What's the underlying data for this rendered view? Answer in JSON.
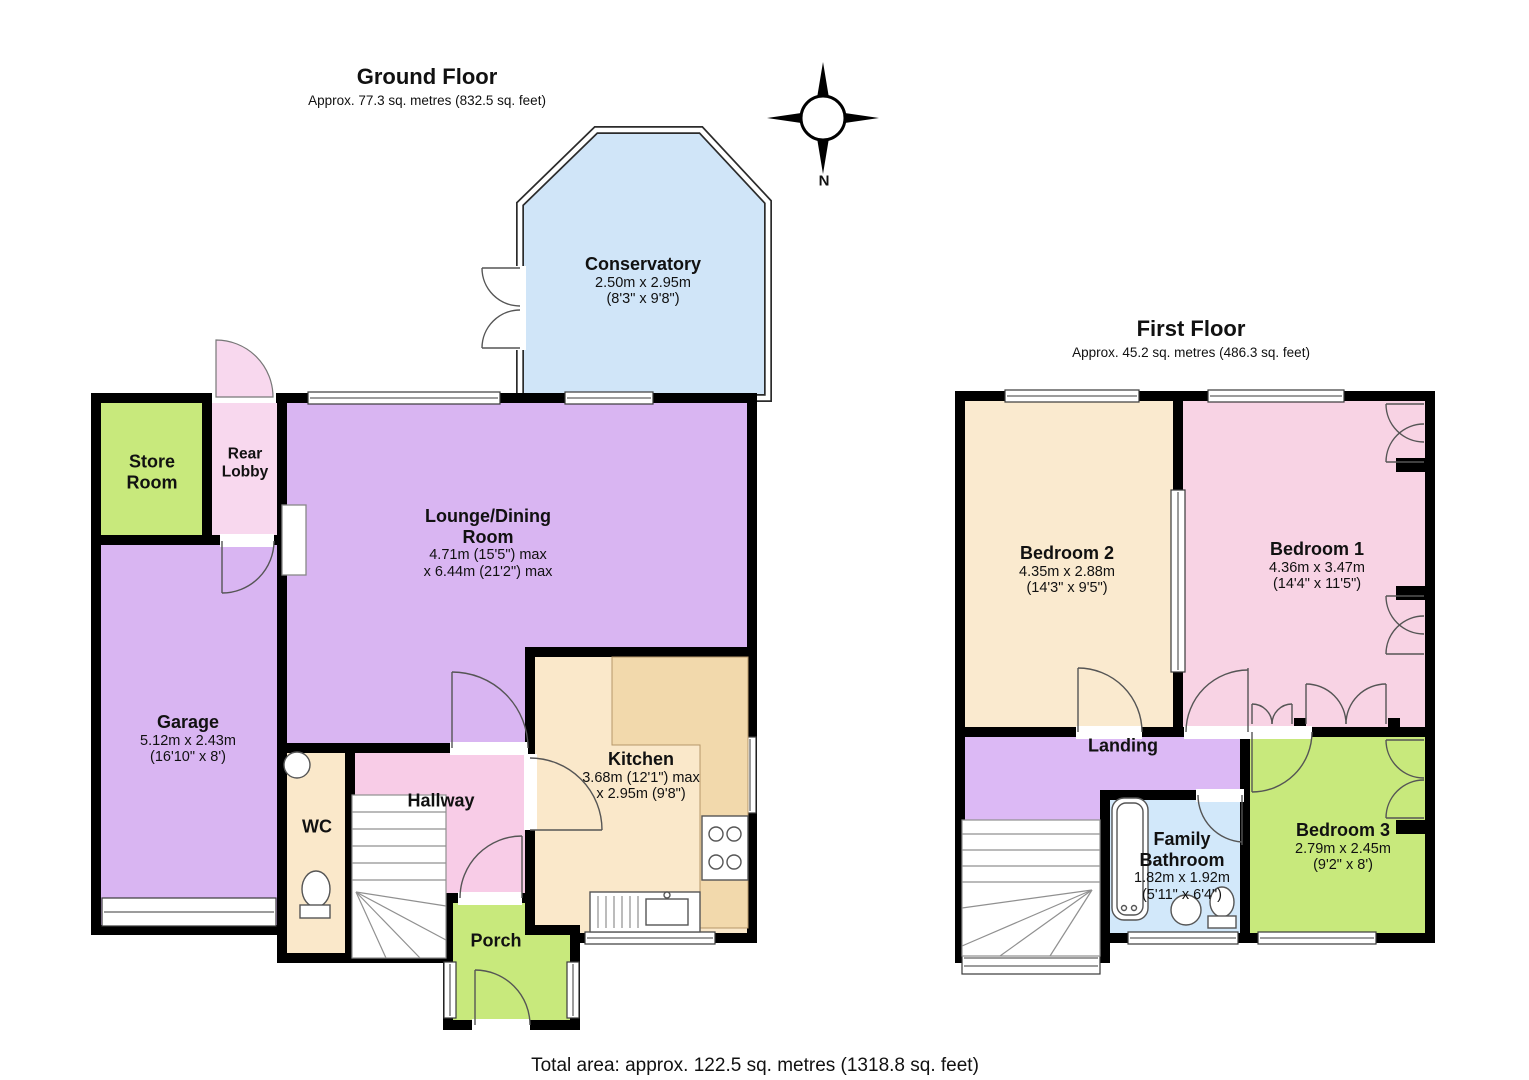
{
  "page": {
    "total_area": "Total area: approx. 122.5 sq. metres (1318.8 sq. feet)"
  },
  "compass": {
    "label": "N"
  },
  "palette": {
    "wall": "#000000",
    "counter": "#f2d9ac"
  },
  "floors": {
    "ground": {
      "title": "Ground Floor",
      "subtitle": "Approx. 77.3 sq. metres (832.5 sq. feet)",
      "rooms": {
        "conservatory": {
          "name": "Conservatory",
          "dim_metric": "2.50m x 2.95m",
          "dim_imperial": "(8'3\" x 9'8\")",
          "color": "#d0e5f8"
        },
        "store_room": {
          "name": "Store Room",
          "color": "#c8e97c"
        },
        "rear_lobby": {
          "name": "Rear Lobby",
          "color": "#f8d8ee"
        },
        "lounge_dining": {
          "name": "Lounge/Dining Room",
          "dim_metric": "4.71m (15'5\") max",
          "dim_imperial": "x 6.44m (21'2\") max",
          "color": "#d9b5f2"
        },
        "garage": {
          "name": "Garage",
          "dim_metric": "5.12m x 2.43m",
          "dim_imperial": "(16'10\" x 8')",
          "color": "#d9b5f2"
        },
        "wc": {
          "name": "WC",
          "color": "#fae8ca"
        },
        "hallway": {
          "name": "Hallway",
          "color": "#f8cce7"
        },
        "kitchen": {
          "name": "Kitchen",
          "dim_metric": "3.68m (12'1\") max",
          "dim_imperial": "x 2.95m (9'8\")",
          "color": "#fae8ca"
        },
        "porch": {
          "name": "Porch",
          "color": "#c8e97c"
        }
      }
    },
    "first": {
      "title": "First Floor",
      "subtitle": "Approx. 45.2 sq. metres (486.3 sq. feet)",
      "rooms": {
        "bedroom2": {
          "name": "Bedroom 2",
          "dim_metric": "4.35m x 2.88m",
          "dim_imperial": "(14'3\" x 9'5\")",
          "color": "#faeacf"
        },
        "bedroom1": {
          "name": "Bedroom 1",
          "dim_metric": "4.36m x 3.47m",
          "dim_imperial": "(14'4\" x 11'5\")",
          "color": "#f8d3e4"
        },
        "landing": {
          "name": "Landing",
          "color": "#dcb9f5"
        },
        "family_bathroom": {
          "name": "Family Bathroom",
          "dim_metric": "1.82m x 1.92m",
          "dim_imperial": "(5'11\" x 6'4\")",
          "color": "#d2e8fa"
        },
        "bedroom3": {
          "name": "Bedroom 3",
          "dim_metric": "2.79m x 2.45m",
          "dim_imperial": "(9'2\" x 8')",
          "color": "#c8e97c"
        }
      }
    }
  }
}
